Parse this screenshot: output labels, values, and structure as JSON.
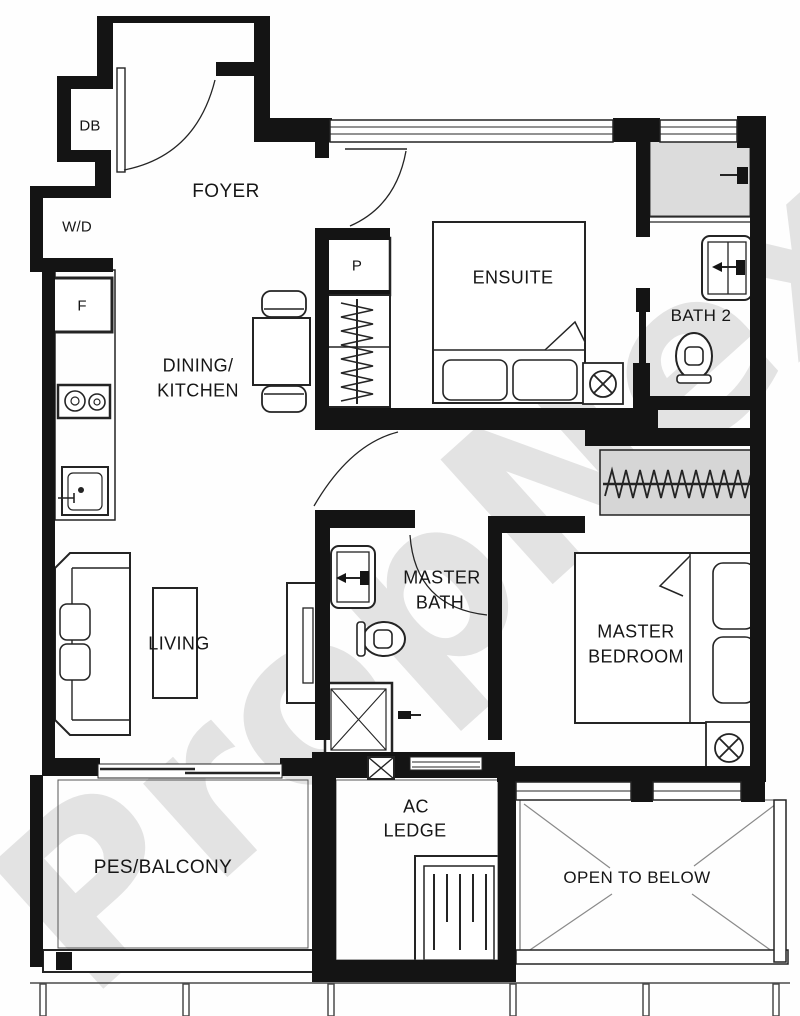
{
  "watermark": "PropNex",
  "rooms": {
    "foyer": "FOYER",
    "dining_kitchen_line1": "DINING/",
    "dining_kitchen_line2": "KITCHEN",
    "ensuite": "ENSUITE",
    "bath2": "BATH 2",
    "master_bath_line1": "MASTER",
    "master_bath_line2": "BATH",
    "master_bedroom_line1": "MASTER",
    "master_bedroom_line2": "BEDROOM",
    "living": "LIVING",
    "pes_balcony": "PES/BALCONY",
    "ac_ledge_line1": "AC",
    "ac_ledge_line2": "LEDGE",
    "open_to_below": "OPEN TO BELOW"
  },
  "fixtures": {
    "distribution_board": "DB",
    "washer_dryer": "W/D",
    "fridge": "F",
    "pantry": "P"
  },
  "colors": {
    "wall": "#141414",
    "line": "#242424",
    "shade": "#d9d9d9",
    "watermark": "#c9c9c9"
  }
}
